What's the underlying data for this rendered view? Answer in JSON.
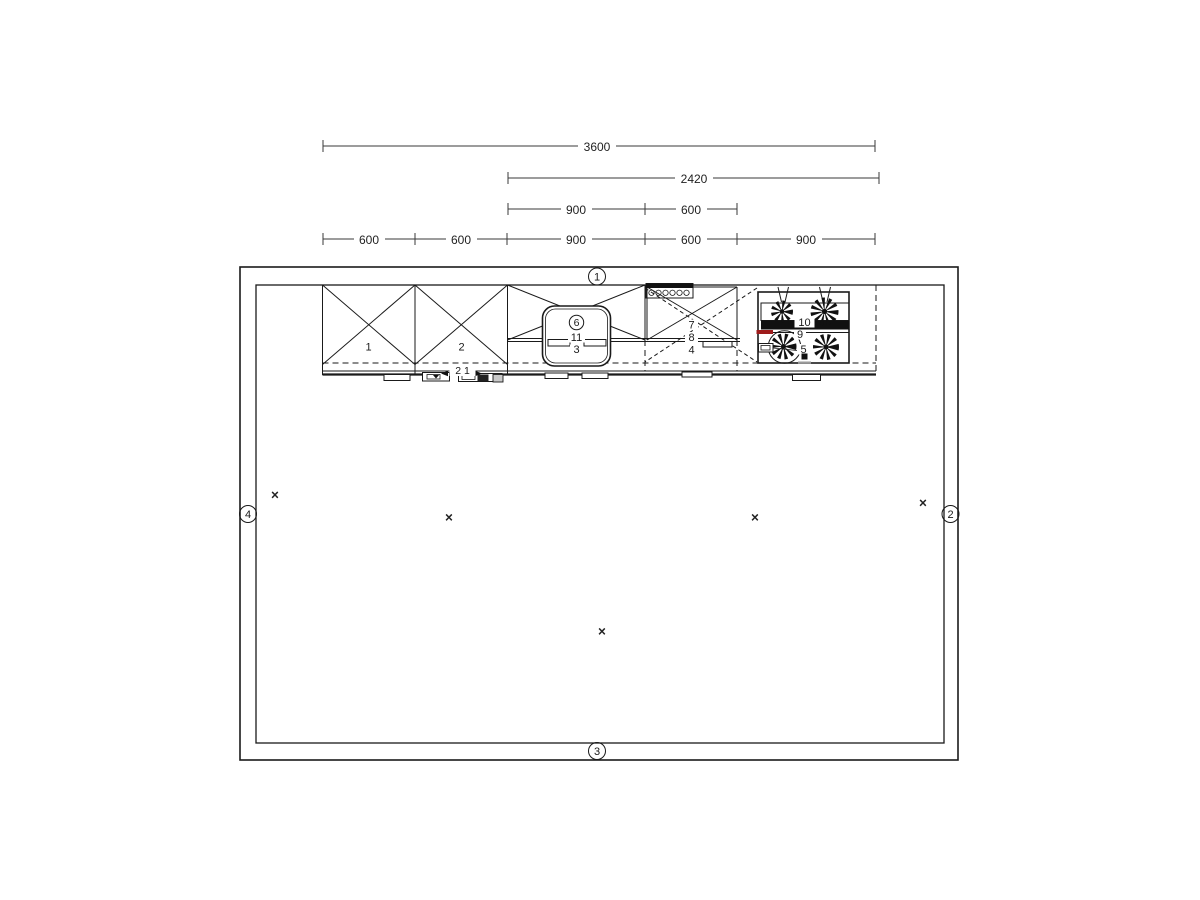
{
  "drawing": {
    "type": "kitchen-floor-plan",
    "background": "#ffffff",
    "line_color": "#1a1a1a",
    "accent_red": "#9e1b1b"
  },
  "dimensions": {
    "total": "3600",
    "right_run": "2420",
    "mid_segments": [
      "900",
      "600"
    ],
    "bottom_segments": [
      "600",
      "600",
      "900",
      "600",
      "900"
    ]
  },
  "wall_markers": {
    "top": "1",
    "right": "2",
    "bottom": "3",
    "left": "4"
  },
  "item_labels": {
    "tall_cabinet_left": "1",
    "tall_cabinet_right": "2",
    "sink_base_cabinet": "3",
    "base_cabinet": "4",
    "hob": "5",
    "sink_circle": "6",
    "wall_cabinet": "7",
    "wall_cabinet_lower": "8",
    "hob_mid": "9",
    "hob_rail": "10",
    "sink_inner": "11",
    "under_cabinet_pair": "2 1"
  },
  "marks": {
    "symbol": "×"
  }
}
